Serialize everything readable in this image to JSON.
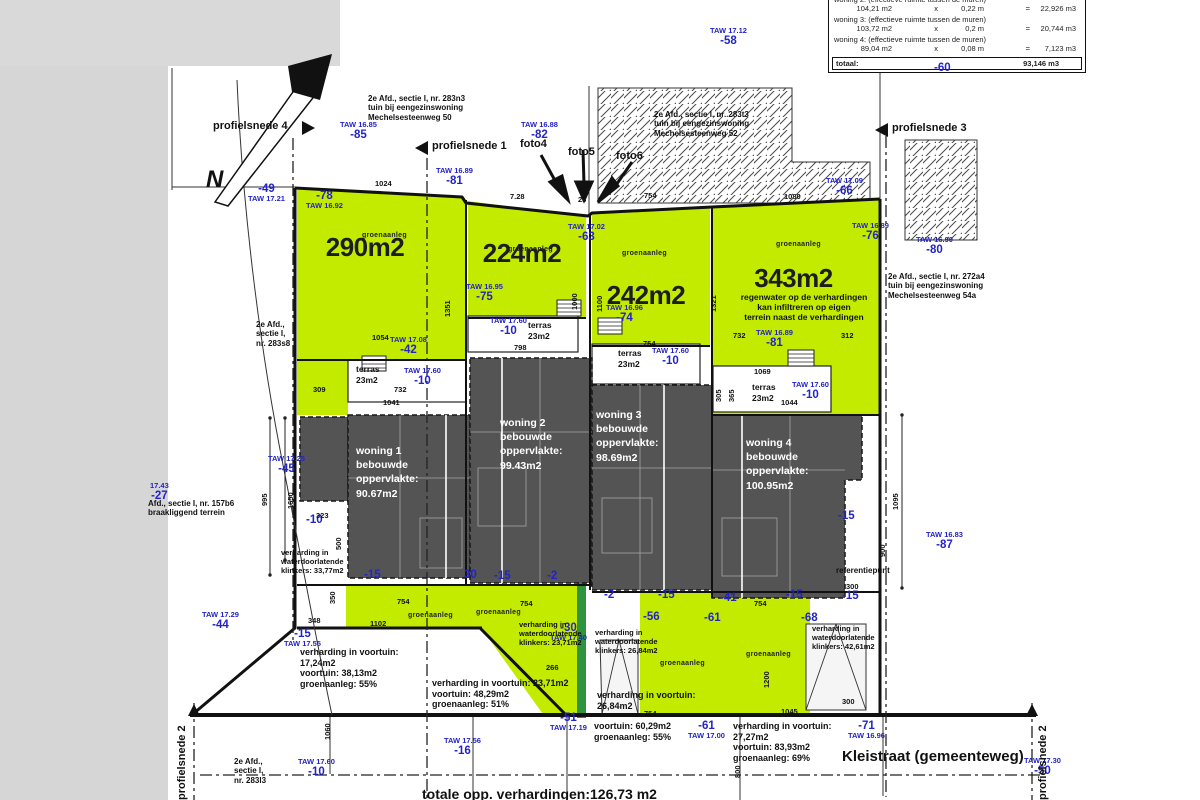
{
  "colors": {
    "green": "#c3eb00",
    "dark_green": "#2e9440",
    "house_gray": "#545454",
    "blue": "#2323c8",
    "hatch": "#4a4a4a"
  },
  "table": {
    "rows": [
      {
        "label": "woning 2: (effectieve ruimte tussen de muren)",
        "area": "104,21 m2",
        "op": "x",
        "depth": "0,22 m",
        "eq": "=",
        "vol": "22,926 m3"
      },
      {
        "label": "woning 3: (effectieve ruimte tussen de muren)",
        "area": "103,72 m2",
        "op": "x",
        "depth": "0,2 m",
        "eq": "=",
        "vol": "20,744 m3"
      },
      {
        "label": "woning 4: (effectieve ruimte tussen de muren)",
        "area": "89,04 m2",
        "op": "x",
        "depth": "0,08 m",
        "eq": "=",
        "vol": "7,123 m3"
      }
    ],
    "total_label": "totaal:",
    "total_value": "93,146 m3"
  },
  "plots": [
    {
      "t": "290m2",
      "x": 290,
      "y": 232,
      "w": 150
    },
    {
      "t": "224m2",
      "x": 458,
      "y": 238,
      "w": 128
    },
    {
      "t": "242m2",
      "x": 582,
      "y": 280,
      "w": 128
    },
    {
      "t": "343m2",
      "x": 716,
      "y": 263,
      "w": 155
    }
  ],
  "houses": [
    {
      "name": "woning 1",
      "label": "bebouwde\noppervlakte:",
      "area": "90.67m2",
      "x": 356,
      "y": 444,
      "w": 108
    },
    {
      "name": "woning 2",
      "label": "bebouwde\noppervlakte:",
      "area": "99.43m2",
      "x": 500,
      "y": 416,
      "w": 110
    },
    {
      "name": "woning 3",
      "label": "bebouwde\noppervlakte:",
      "area": "98.69m2",
      "x": 596,
      "y": 408,
      "w": 112
    },
    {
      "name": "woning 4",
      "label": "bebouwde\noppervlakte:",
      "area": "100.95m2",
      "x": 746,
      "y": 436,
      "w": 118
    }
  ],
  "terraces": [
    {
      "label": "terras",
      "area": "23m2",
      "x": 356,
      "y": 364
    },
    {
      "label": "terras",
      "area": "23m2",
      "x": 528,
      "y": 320
    },
    {
      "label": "terras",
      "area": "23m2",
      "x": 618,
      "y": 348
    },
    {
      "label": "terras",
      "area": "23m2",
      "x": 752,
      "y": 382
    }
  ],
  "groen": [
    {
      "t": "groenaanleg",
      "x": 362,
      "y": 232
    },
    {
      "t": "groenaanleg",
      "x": 508,
      "y": 246
    },
    {
      "t": "groenaanleg",
      "x": 622,
      "y": 250
    },
    {
      "t": "groenaanleg",
      "x": 776,
      "y": 241
    },
    {
      "t": "groenaanleg",
      "x": 408,
      "y": 612
    },
    {
      "t": "groenaanleg",
      "x": 476,
      "y": 609
    },
    {
      "t": "groenaanleg",
      "x": 660,
      "y": 660
    },
    {
      "t": "groenaanleg",
      "x": 746,
      "y": 651
    }
  ],
  "taw": [
    {
      "t": "TAW 17.12",
      "v": "-58",
      "x": 710,
      "y": 27
    },
    {
      "t": "TAW 16.85",
      "v": "-85",
      "x": 340,
      "y": 121
    },
    {
      "t": "TAW 16.88",
      "v": "-82",
      "x": 521,
      "y": 121
    },
    {
      "t": "TAW 16.89",
      "v": "-81",
      "x": 436,
      "y": 167
    },
    {
      "t": "TAW 17.09",
      "v": "-66",
      "x": 826,
      "y": 177
    },
    {
      "t": "TAW 17.21",
      "v": "-49",
      "x": 248,
      "y": 183,
      "f": 1
    },
    {
      "t": "TAW 16.92",
      "v": "-78",
      "x": 306,
      "y": 190,
      "f": 1
    },
    {
      "t": "TAW 17.02",
      "v": "-63",
      "x": 568,
      "y": 223
    },
    {
      "t": "TAW 16.89",
      "v": "-76",
      "x": 852,
      "y": 222
    },
    {
      "t": "TAW 16.90",
      "v": "-80",
      "x": 916,
      "y": 236
    },
    {
      "t": "TAW 16.95",
      "v": "-75",
      "x": 466,
      "y": 283
    },
    {
      "t": "TAW 16.96",
      "v": "-74",
      "x": 606,
      "y": 304
    },
    {
      "t": "TAW 17.60",
      "v": "-10",
      "x": 490,
      "y": 317
    },
    {
      "t": "TAW 16.89",
      "v": "-81",
      "x": 756,
      "y": 329
    },
    {
      "t": "TAW 17.08",
      "v": "-42",
      "x": 390,
      "y": 336
    },
    {
      "t": "TAW 17.60",
      "v": "-10",
      "x": 404,
      "y": 367
    },
    {
      "t": "TAW 17.60",
      "v": "-10",
      "x": 652,
      "y": 347
    },
    {
      "t": "TAW 17.60",
      "v": "-10",
      "x": 792,
      "y": 381
    },
    {
      "t": "TAW 17.55",
      "v": "-15",
      "x": 284,
      "y": 628,
      "f": 1
    },
    {
      "t": "17.43",
      "v": "-27",
      "x": 150,
      "y": 482
    },
    {
      "t": "TAW 17.29",
      "v": "-44",
      "x": 202,
      "y": 611
    },
    {
      "t": "TAW 17.40",
      "v": "-30",
      "x": 550,
      "y": 622,
      "f": 1
    },
    {
      "t": "TAW 16.83",
      "v": "-87",
      "x": 926,
      "y": 531
    },
    {
      "t": "TAW 17.56",
      "v": "-16",
      "x": 444,
      "y": 737
    },
    {
      "t": "TAW 17.19",
      "v": "-51",
      "x": 550,
      "y": 712,
      "f": 1
    },
    {
      "t": "TAW 17.00",
      "v": "-61",
      "x": 688,
      "y": 720,
      "f": 1
    },
    {
      "t": "TAW 16.96",
      "v": "-71",
      "x": 848,
      "y": 720,
      "f": 1
    },
    {
      "t": "TAW 17.30",
      "v": "-50",
      "x": 1024,
      "y": 757
    },
    {
      "t": "TAW 17.60",
      "v": "-10",
      "x": 298,
      "y": 758
    },
    {
      "t": "TAW 17.25",
      "v": "-45",
      "x": 268,
      "y": 455
    }
  ],
  "levels": [
    {
      "v": "-60",
      "x": 934,
      "y": 62
    },
    {
      "v": "-41",
      "x": 720,
      "y": 592
    },
    {
      "v": "-15",
      "x": 364,
      "y": 569
    },
    {
      "v": "30",
      "x": 464,
      "y": 569
    },
    {
      "v": "-15",
      "x": 494,
      "y": 570
    },
    {
      "v": "-2",
      "x": 547,
      "y": 570
    },
    {
      "v": "-2",
      "x": 604,
      "y": 589
    },
    {
      "v": "-15",
      "x": 658,
      "y": 589
    },
    {
      "v": "-56",
      "x": 643,
      "y": 611
    },
    {
      "v": "-61",
      "x": 704,
      "y": 612
    },
    {
      "v": "-68",
      "x": 801,
      "y": 612
    },
    {
      "v": "-15",
      "x": 786,
      "y": 589
    },
    {
      "v": "-15",
      "x": 842,
      "y": 590
    },
    {
      "v": "-15",
      "x": 838,
      "y": 510
    },
    {
      "v": "-10",
      "x": 306,
      "y": 514
    }
  ],
  "dims": [
    {
      "t": "1024",
      "x": 375,
      "y": 179
    },
    {
      "t": "7.28",
      "x": 510,
      "y": 192
    },
    {
      "t": "23",
      "x": 578,
      "y": 195
    },
    {
      "t": "754",
      "x": 644,
      "y": 191
    },
    {
      "t": "1080",
      "x": 784,
      "y": 192
    },
    {
      "t": "1054",
      "x": 372,
      "y": 333
    },
    {
      "t": "798",
      "x": 514,
      "y": 343
    },
    {
      "t": "754",
      "x": 643,
      "y": 339
    },
    {
      "t": "732",
      "x": 733,
      "y": 331
    },
    {
      "t": "312",
      "x": 841,
      "y": 331
    },
    {
      "t": "1069",
      "x": 754,
      "y": 367
    },
    {
      "t": "1044",
      "x": 781,
      "y": 398
    },
    {
      "t": "305",
      "x": 714,
      "y": 402,
      "r": 1
    },
    {
      "t": "365",
      "x": 727,
      "y": 402,
      "r": 1
    },
    {
      "t": "309",
      "x": 313,
      "y": 385
    },
    {
      "t": "732",
      "x": 394,
      "y": 385
    },
    {
      "t": "1041",
      "x": 383,
      "y": 398
    },
    {
      "t": "323",
      "x": 316,
      "y": 511
    },
    {
      "t": "500",
      "x": 334,
      "y": 550,
      "r": 1
    },
    {
      "t": "350",
      "x": 328,
      "y": 604,
      "r": 1
    },
    {
      "t": "348",
      "x": 308,
      "y": 616
    },
    {
      "t": "754",
      "x": 397,
      "y": 597
    },
    {
      "t": "1102",
      "x": 370,
      "y": 619
    },
    {
      "t": "754",
      "x": 520,
      "y": 599
    },
    {
      "t": "266",
      "x": 546,
      "y": 663
    },
    {
      "t": "754",
      "x": 754,
      "y": 599
    },
    {
      "t": "1045",
      "x": 781,
      "y": 707
    },
    {
      "t": "300",
      "x": 846,
      "y": 582
    },
    {
      "t": "300",
      "x": 842,
      "y": 697
    },
    {
      "t": "995",
      "x": 260,
      "y": 506,
      "r": 1
    },
    {
      "t": "1650",
      "x": 286,
      "y": 509,
      "r": 1
    },
    {
      "t": "1351",
      "x": 443,
      "y": 317,
      "r": 1
    },
    {
      "t": "1000",
      "x": 570,
      "y": 310,
      "r": 1
    },
    {
      "t": "1100",
      "x": 595,
      "y": 312,
      "r": 1
    },
    {
      "t": "1321",
      "x": 709,
      "y": 312,
      "r": 1
    },
    {
      "t": "1095",
      "x": 891,
      "y": 510,
      "r": 1
    },
    {
      "t": "900",
      "x": 878,
      "y": 557,
      "r": 1
    },
    {
      "t": "1060",
      "x": 323,
      "y": 740,
      "r": 1
    },
    {
      "t": "800",
      "x": 733,
      "y": 778,
      "r": 1
    },
    {
      "t": "1200",
      "x": 762,
      "y": 688,
      "r": 1
    },
    {
      "t": "754",
      "x": 644,
      "y": 709
    }
  ],
  "notes": [
    {
      "t": "2e Afd., sectie I, nr. 283n3\ntuin bij eengezinswoning\nMechelsesteenweg 50",
      "x": 368,
      "y": 94,
      "w": 132,
      "s": 8
    },
    {
      "t": "2e Afd., sectie I, nr. 283t3\ntuin bij eengezinswoning\nMechelsesteenweg 52",
      "x": 654,
      "y": 110,
      "w": 128,
      "s": 8
    },
    {
      "t": "2e Afd., sectie I, nr. 272a4\ntuin bij eengezinswoning\nMechelsesteenweg 54a",
      "x": 888,
      "y": 272,
      "w": 118,
      "s": 8
    },
    {
      "t": "2e Afd.,\nsectie I,\nnr. 283s8",
      "x": 256,
      "y": 320,
      "w": 55,
      "s": 8
    },
    {
      "t": "Afd., sectie I, nr. 157b6\nbraakliggend terrein",
      "x": 148,
      "y": 499,
      "w": 128,
      "s": 8
    },
    {
      "t": "2e Afd.,\nsectie I,\nnr. 283l3",
      "x": 234,
      "y": 757,
      "w": 55,
      "s": 8
    },
    {
      "t": "regenwater op de verhardingen\nkan infiltreren op eigen\nterrein naast de verhardingen",
      "x": 720,
      "y": 292,
      "w": 168,
      "s": 8.5,
      "a": "center"
    },
    {
      "t": "verharding in\nwaterdoorlatende\nklinkers: 33,77m2",
      "x": 281,
      "y": 549,
      "w": 88,
      "s": 7.5
    },
    {
      "t": "verharding in\nwaterdoorlatende\nklinkers: 23,71m2",
      "x": 519,
      "y": 621,
      "w": 96,
      "s": 7.5
    },
    {
      "t": "verharding in\nwaterdoorlatende\nklinkers: 26,84m2",
      "x": 595,
      "y": 629,
      "w": 88,
      "s": 7.5
    },
    {
      "t": "verharding in\nwaterdoorlatende\nklinkers: 42,61m2",
      "x": 812,
      "y": 625,
      "w": 96,
      "s": 7.5
    },
    {
      "t": "verharding in voortuin:\n17,24m2\nvoortuin: 38,13m2\ngroenaanleg: 55%",
      "x": 300,
      "y": 647,
      "w": 160,
      "s": 9
    },
    {
      "t": "verharding in voortuin: 23,71m2\nvoortuin: 48,29m2\ngroenaanleg: 51%",
      "x": 432,
      "y": 678,
      "w": 262,
      "s": 9
    },
    {
      "t": "verharding in voortuin:\n26,84m2",
      "x": 597,
      "y": 690,
      "w": 118,
      "s": 9
    },
    {
      "t": "voortuin: 60,29m2\ngroenaanleg: 55%",
      "x": 594,
      "y": 721,
      "w": 122,
      "s": 9
    },
    {
      "t": "verharding in voortuin:\n27,27m2\nvoortuin: 83,93m2\ngroenaanleg: 69%",
      "x": 733,
      "y": 721,
      "w": 118,
      "s": 9
    },
    {
      "t": "referentiepunt",
      "x": 836,
      "y": 566,
      "w": 82,
      "s": 8
    },
    {
      "t": "Kleistraat (gemeenteweg)",
      "x": 842,
      "y": 748,
      "w": 235,
      "s": 15
    },
    {
      "t": "totale opp. verhardingen:126,73 m2",
      "x": 422,
      "y": 786,
      "w": 285,
      "s": 14
    },
    {
      "t": "profielsnede 4",
      "x": 213,
      "y": 120,
      "w": 92,
      "s": 11
    },
    {
      "t": "profielsnede 1",
      "x": 432,
      "y": 140,
      "w": 92,
      "s": 11
    },
    {
      "t": "profielsnede 3",
      "x": 892,
      "y": 122,
      "w": 92,
      "s": 11
    },
    {
      "t": "profielsnede 2",
      "x": 176,
      "y": 800,
      "w": 92,
      "s": 11,
      "r": -90
    },
    {
      "t": "profielsnede 2",
      "x": 1037,
      "y": 800,
      "w": 92,
      "s": 11,
      "r": -90
    },
    {
      "t": "foto4",
      "x": 520,
      "y": 138,
      "w": 45,
      "s": 11
    },
    {
      "t": "foto5",
      "x": 568,
      "y": 146,
      "w": 45,
      "s": 11
    },
    {
      "t": "foto6",
      "x": 616,
      "y": 150,
      "w": 45,
      "s": 11
    },
    {
      "t": "N",
      "x": 206,
      "y": 166,
      "w": 30,
      "s": 24,
      "i": 1
    }
  ]
}
